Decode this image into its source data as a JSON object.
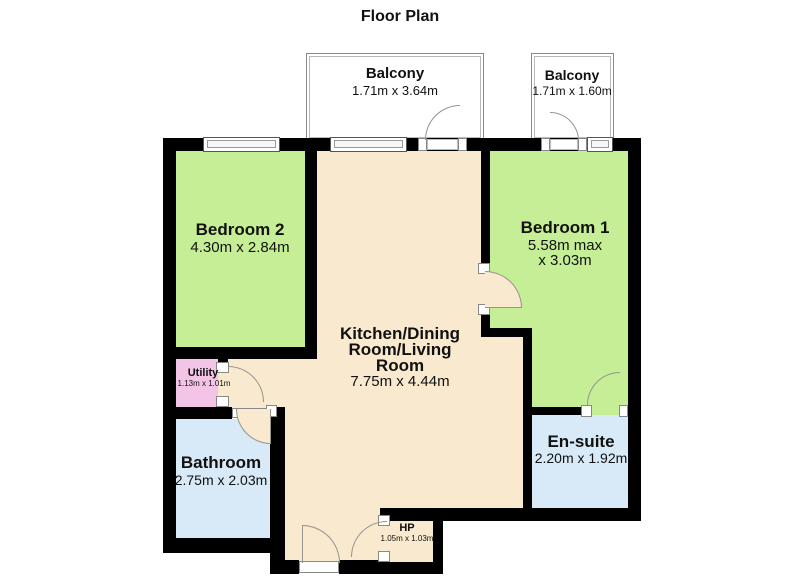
{
  "title": "Floor Plan",
  "colors": {
    "wall": "#000000",
    "bedroom": "#c6ee96",
    "kitchen": "#f8e9cf",
    "bath": "#d8eaf7",
    "utility": "#f4c4e6",
    "door_arc": "#95958b"
  },
  "balconies": [
    {
      "name": "Balcony",
      "dims": "1.71m x 3.64m"
    },
    {
      "name": "Balcony",
      "dims": "1.71m x 1.60m"
    }
  ],
  "rooms": {
    "bedroom2": {
      "name": "Bedroom 2",
      "dims": "4.30m x 2.84m"
    },
    "bedroom1": {
      "name": "Bedroom 1",
      "dims_line1": "5.58m max",
      "dims_line2": "x 3.03m"
    },
    "kitchen": {
      "name_line1": "Kitchen/Dining",
      "name_line2": "Room/Living",
      "name_line3": "Room",
      "dims": "7.75m x 4.44m"
    },
    "utility": {
      "name": "Utility",
      "dims": "1.13m x 1.01m"
    },
    "bathroom": {
      "name": "Bathroom",
      "dims": "2.75m x 2.03m"
    },
    "ensuite": {
      "name": "En-suite",
      "dims": "2.20m x 1.92m"
    },
    "hp": {
      "name": "HP",
      "dims": "1.05m x 1.03m"
    }
  }
}
